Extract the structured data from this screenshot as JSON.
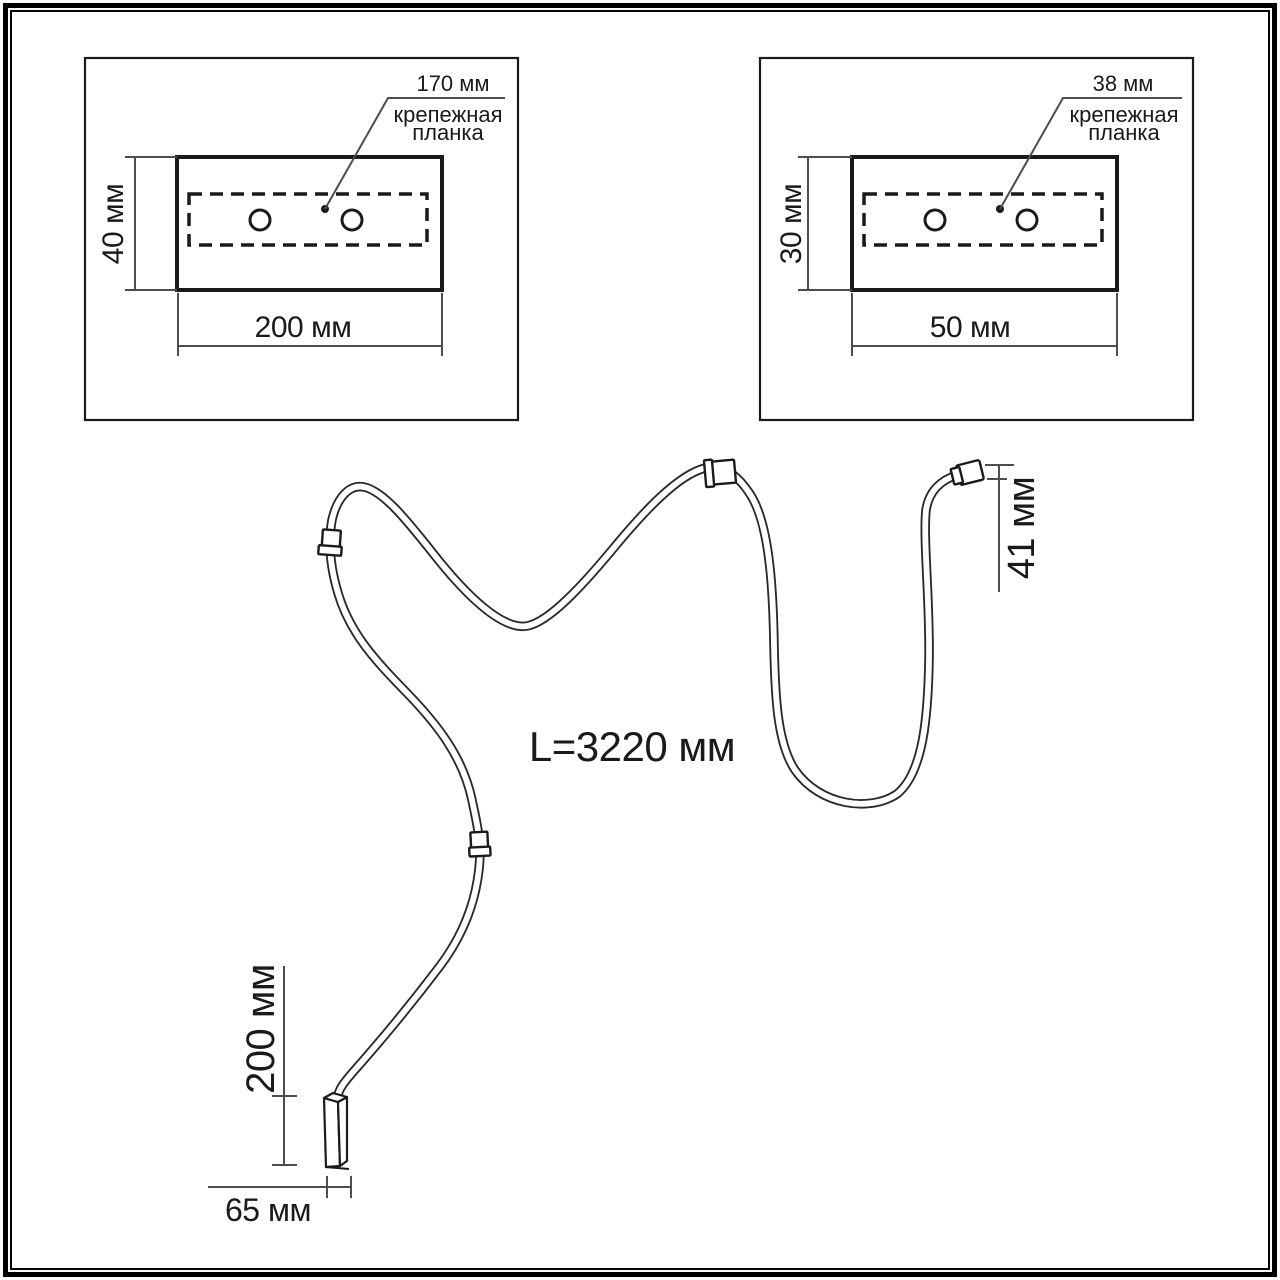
{
  "colors": {
    "background": "#ffffff",
    "ink": "#1a1a1a",
    "dim": "#4d4d4d"
  },
  "detail_left": {
    "offset_value": "170 мм",
    "label_line1": "крепежная",
    "label_line2": "планка",
    "height": "40 мм",
    "width": "200 мм"
  },
  "detail_right": {
    "offset_value": "38 мм",
    "label_line1": "крепежная",
    "label_line2": "планка",
    "height": "30 мм",
    "width": "50 мм"
  },
  "cable": {
    "total_length": "L=3220 мм",
    "end_cap_length": "41 мм",
    "connector_length": "200 мм",
    "connector_width": "65 мм"
  }
}
